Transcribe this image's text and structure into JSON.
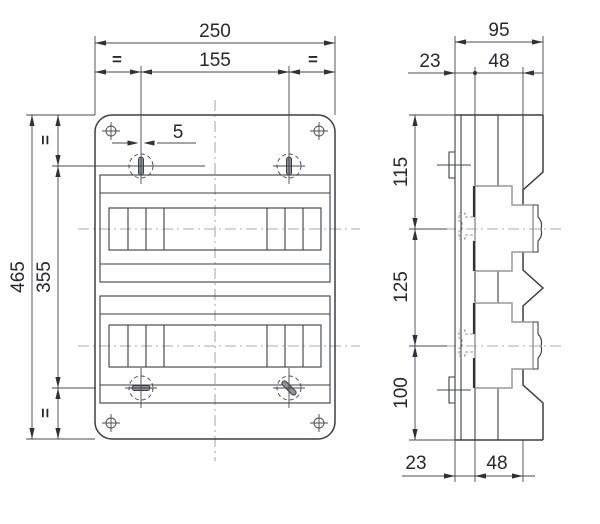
{
  "front_view": {
    "width_total": "250",
    "width_between_slots": "155",
    "slot_width": "5",
    "height_total": "465",
    "height_between_slots": "355",
    "equal_mark": "="
  },
  "side_view": {
    "depth_total": "95",
    "top_offset": "23",
    "top_rail": "48",
    "spacing_top": "115",
    "spacing_middle": "125",
    "spacing_bottom": "100",
    "bottom_offset": "23",
    "bottom_rail": "48"
  }
}
